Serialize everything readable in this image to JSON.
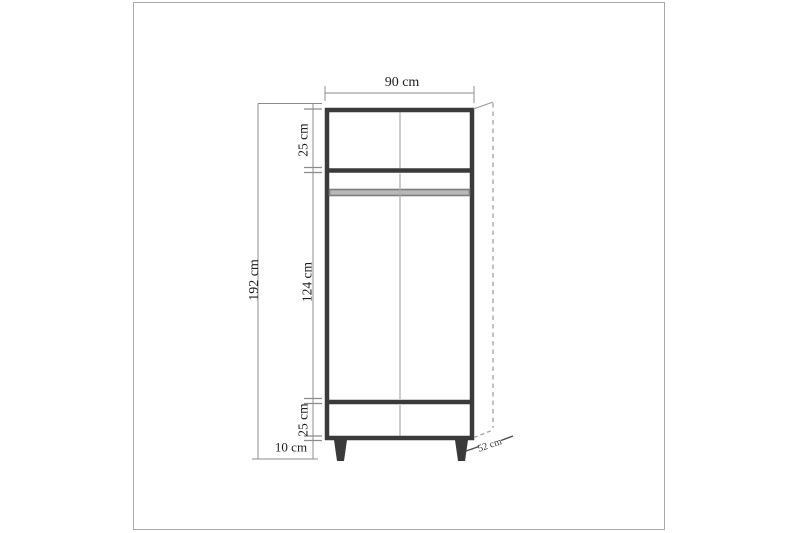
{
  "figure": {
    "type": "furniture-dimension-drawing",
    "subject": "two-door wardrobe front elevation with depth indication",
    "labels": {
      "width": "90 cm",
      "height_total": "192 cm",
      "section_top": "25 cm",
      "section_middle": "124 cm",
      "section_bottom": "25 cm",
      "legs": "10 cm",
      "depth": "52 cm"
    },
    "colors": {
      "outline": "#3a3a3a",
      "thin_interior_line": "#ababab",
      "rod_fill": "#b8b8b8",
      "rod_edge": "#7d7d7d",
      "dimension_line": "#8c8c8c",
      "depth_dash_line": "#9a9a9a",
      "text": "#1c1c1c",
      "frame_border": "#aaaaaa",
      "background": "#ffffff"
    }
  }
}
